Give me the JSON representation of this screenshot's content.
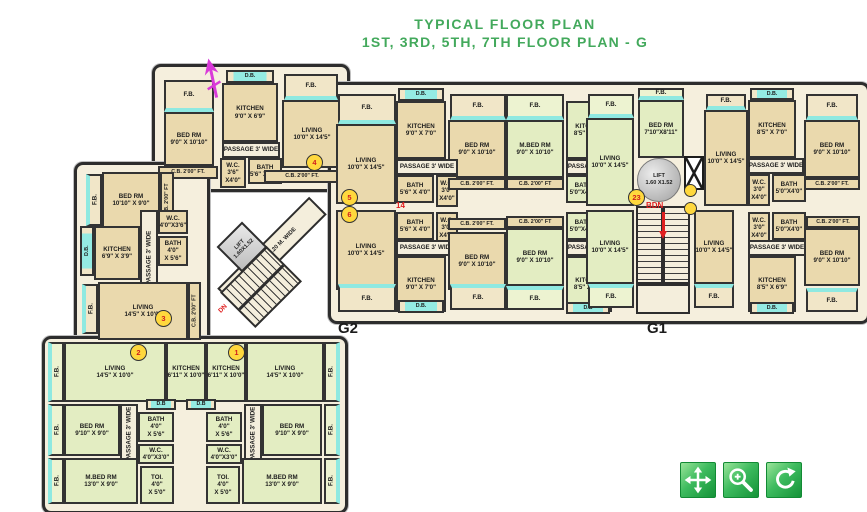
{
  "title": {
    "line1": "TYPICAL FLOOR PLAN",
    "line2": "1ST, 3RD, 5TH, 7TH FLOOR PLAN - G"
  },
  "wings": {
    "g1": "G1",
    "g2": "G2"
  },
  "core": {
    "lift_core_l1": "LIFT",
    "lift_core_l2": "1.60X1.52",
    "lift_g1_l1": "LIFT",
    "lift_g1_l2": "1.60 X1.52",
    "passage_diag": "PASSAGE 1.20 M. WIDE",
    "up": "UP",
    "dn": "DN",
    "bdn": "BDN"
  },
  "colors": {
    "title_green": "#43a95c",
    "wall": "#2d2d2d",
    "room_tan": "#ead9ad",
    "room_green": "#e3edc2",
    "window_cyan": "#8fe9e1",
    "badge_yellow": "#ffd83d",
    "annotation_red": "#e02020",
    "north_arrow_magenta": "#d93ad9",
    "button_green_light": "#9ae49a",
    "button_green_dark": "#149238"
  },
  "badges": [
    {
      "n": "4",
      "x": 306,
      "y": 154
    },
    {
      "n": "3",
      "x": 155,
      "y": 310
    },
    {
      "n": "5",
      "x": 341,
      "y": 189
    },
    {
      "n": "6",
      "x": 341,
      "y": 206
    },
    {
      "n": "2",
      "x": 130,
      "y": 344
    },
    {
      "n": "1",
      "x": 228,
      "y": 344
    },
    {
      "n": "23",
      "x": 628,
      "y": 189
    }
  ],
  "doors": [
    [
      684,
      184
    ],
    [
      684,
      202
    ]
  ],
  "annotations": [
    {
      "t": "14",
      "x": 396,
      "y": 201
    },
    {
      "t": "BDN",
      "x": 646,
      "y": 201
    }
  ],
  "toolbar": {
    "buttons": [
      {
        "name": "pan",
        "icon": "move-icon"
      },
      {
        "name": "zoom-in",
        "icon": "zoom-in-icon"
      },
      {
        "name": "rotate",
        "icon": "rotate-icon"
      }
    ]
  },
  "rooms": [
    {
      "x": 164,
      "y": 80,
      "w": 50,
      "h": 32,
      "c": "bal",
      "win": "b",
      "l": [
        "F.B."
      ]
    },
    {
      "x": 164,
      "y": 112,
      "w": 50,
      "h": 54,
      "c": "tan",
      "l": [
        "BED RM",
        "9'0\" X 10'10\""
      ]
    },
    {
      "x": 158,
      "y": 166,
      "w": 60,
      "h": 13,
      "c": "strip",
      "l": [
        "C.B. 2'00\" FT."
      ]
    },
    {
      "x": 226,
      "y": 70,
      "w": 48,
      "h": 13,
      "c": "db",
      "l": [
        "D.B."
      ]
    },
    {
      "x": 222,
      "y": 83,
      "w": 56,
      "h": 59,
      "c": "tan",
      "l": [
        "KITCHEN",
        "9'0\" X 6'9\""
      ]
    },
    {
      "x": 222,
      "y": 142,
      "w": 58,
      "h": 16,
      "c": "cor",
      "l": [
        "PASSAGE 3' WIDE"
      ]
    },
    {
      "x": 220,
      "y": 158,
      "w": 26,
      "h": 30,
      "c": "tan",
      "l": [
        "W.C.",
        "3'6\"",
        "X4'0\""
      ]
    },
    {
      "x": 248,
      "y": 158,
      "w": 34,
      "h": 26,
      "c": "tan",
      "l": [
        "BATH",
        "5'6\" X 4'0\""
      ]
    },
    {
      "x": 284,
      "y": 74,
      "w": 54,
      "h": 26,
      "c": "bal",
      "win": "b",
      "l": [
        "F.B."
      ]
    },
    {
      "x": 282,
      "y": 100,
      "w": 60,
      "h": 68,
      "c": "tan",
      "l": [
        "LIVING",
        "10'0\" X 14'5\""
      ]
    },
    {
      "x": 264,
      "y": 170,
      "w": 76,
      "h": 13,
      "c": "strip",
      "l": [
        "C.B. 2'00\" FT."
      ]
    },
    {
      "x": 86,
      "y": 174,
      "w": 16,
      "h": 52,
      "c": "bal",
      "v": 1,
      "win": "r",
      "l": [
        "F.B."
      ]
    },
    {
      "x": 102,
      "y": 172,
      "w": 58,
      "h": 56,
      "c": "tan",
      "l": [
        "BED RM",
        "10'10\" X 9'0\""
      ]
    },
    {
      "x": 160,
      "y": 172,
      "w": 14,
      "h": 56,
      "c": "strip",
      "v": 1,
      "l": [
        "C.B. 2'00\" FT"
      ]
    },
    {
      "x": 80,
      "y": 226,
      "w": 14,
      "h": 50,
      "c": "db",
      "v": 1,
      "l": [
        "D.B."
      ]
    },
    {
      "x": 94,
      "y": 226,
      "w": 46,
      "h": 54,
      "c": "tan",
      "l": [
        "KITCHEN",
        "6'9\" X 3'9\""
      ]
    },
    {
      "x": 140,
      "y": 210,
      "w": 18,
      "h": 96,
      "c": "cor",
      "v": 1,
      "l": [
        "PASSAGE 3' WIDE"
      ]
    },
    {
      "x": 158,
      "y": 210,
      "w": 30,
      "h": 24,
      "c": "tan",
      "l": [
        "W.C.",
        "4'0\"X3'6\""
      ]
    },
    {
      "x": 158,
      "y": 236,
      "w": 30,
      "h": 30,
      "c": "tan",
      "l": [
        "BATH",
        "4'0\"",
        "X 5'6\""
      ]
    },
    {
      "x": 82,
      "y": 284,
      "w": 16,
      "h": 50,
      "c": "bal",
      "v": 1,
      "win": "r",
      "l": [
        "F.B."
      ]
    },
    {
      "x": 98,
      "y": 282,
      "w": 90,
      "h": 58,
      "c": "tan",
      "l": [
        "LIVING",
        "14'5\" X 10'0\""
      ]
    },
    {
      "x": 188,
      "y": 282,
      "w": 13,
      "h": 58,
      "c": "strip",
      "v": 1,
      "l": [
        "C.B. 2'00\" FT"
      ]
    },
    {
      "x": 338,
      "y": 94,
      "w": 58,
      "h": 30,
      "c": "bal",
      "win": "b",
      "l": [
        "F.B."
      ]
    },
    {
      "x": 398,
      "y": 88,
      "w": 46,
      "h": 13,
      "c": "db",
      "l": [
        "D.B."
      ]
    },
    {
      "x": 396,
      "y": 101,
      "w": 50,
      "h": 58,
      "c": "tan",
      "l": [
        "KITCHEN",
        "9'0\" X 7'0\""
      ]
    },
    {
      "x": 450,
      "y": 94,
      "w": 56,
      "h": 26,
      "c": "bal",
      "win": "b",
      "l": [
        "F.B."
      ]
    },
    {
      "x": 336,
      "y": 124,
      "w": 60,
      "h": 80,
      "c": "tan",
      "l": [
        "LIVING",
        "10'0\" X 14'5\""
      ]
    },
    {
      "x": 448,
      "y": 120,
      "w": 58,
      "h": 58,
      "c": "tan",
      "l": [
        "BED RM",
        "9'0\" X 10'10\""
      ]
    },
    {
      "x": 396,
      "y": 159,
      "w": 62,
      "h": 16,
      "c": "cor",
      "l": [
        "PASSAGE 3' WIDE"
      ]
    },
    {
      "x": 396,
      "y": 175,
      "w": 38,
      "h": 28,
      "c": "tan",
      "l": [
        "BATH",
        "5'6\" X 4'0\""
      ]
    },
    {
      "x": 436,
      "y": 175,
      "w": 22,
      "h": 32,
      "c": "tan",
      "l": [
        "W.C.",
        "3'0\"",
        "X4'0\""
      ]
    },
    {
      "x": 448,
      "y": 178,
      "w": 58,
      "h": 12,
      "c": "strip",
      "l": [
        "C.B. 2'00\" FT."
      ]
    },
    {
      "x": 396,
      "y": 212,
      "w": 38,
      "h": 28,
      "c": "tan",
      "l": [
        "BATH",
        "5'6\" X 4'0\""
      ]
    },
    {
      "x": 436,
      "y": 212,
      "w": 22,
      "h": 32,
      "c": "tan",
      "l": [
        "W.C.",
        "3'0\"",
        "X4'0\""
      ]
    },
    {
      "x": 448,
      "y": 218,
      "w": 58,
      "h": 12,
      "c": "strip",
      "l": [
        "C.B. 2'00\" FT."
      ]
    },
    {
      "x": 336,
      "y": 210,
      "w": 60,
      "h": 80,
      "c": "tan",
      "l": [
        "LIVING",
        "10'0\" X 14'5\""
      ]
    },
    {
      "x": 396,
      "y": 240,
      "w": 62,
      "h": 16,
      "c": "cor",
      "l": [
        "PASSAGE 3' WIDE"
      ]
    },
    {
      "x": 448,
      "y": 232,
      "w": 58,
      "h": 58,
      "c": "tan",
      "l": [
        "BED RM",
        "9'0\" X 10'10\""
      ]
    },
    {
      "x": 396,
      "y": 256,
      "w": 50,
      "h": 56,
      "c": "tan",
      "l": [
        "KITCHEN",
        "9'0\" X 7'0\""
      ]
    },
    {
      "x": 338,
      "y": 284,
      "w": 58,
      "h": 28,
      "c": "bal",
      "win": "t",
      "l": [
        "F.B."
      ]
    },
    {
      "x": 450,
      "y": 284,
      "w": 56,
      "h": 26,
      "c": "bal",
      "win": "t",
      "l": [
        "F.B."
      ]
    },
    {
      "x": 398,
      "y": 300,
      "w": 46,
      "h": 13,
      "c": "db",
      "l": [
        "D.B."
      ]
    },
    {
      "x": 506,
      "y": 94,
      "w": 58,
      "h": 26,
      "c": "gbal",
      "win": "b",
      "l": [
        "F.B."
      ]
    },
    {
      "x": 506,
      "y": 120,
      "w": 58,
      "h": 58,
      "c": "green",
      "l": [
        "M.BED RM",
        "9'0\" X 10'10\""
      ]
    },
    {
      "x": 566,
      "y": 101,
      "w": 46,
      "h": 58,
      "c": "green",
      "l": [
        "KITCHEN",
        "8'5\" X 7'0\""
      ]
    },
    {
      "x": 566,
      "y": 159,
      "w": 58,
      "h": 16,
      "c": "cor",
      "l": [
        "PASSAGE 3' WIDE"
      ]
    },
    {
      "x": 566,
      "y": 175,
      "w": 34,
      "h": 28,
      "c": "green",
      "l": [
        "BATH",
        "5'0\"X4'0\""
      ]
    },
    {
      "x": 602,
      "y": 175,
      "w": 20,
      "h": 30,
      "c": "green",
      "l": [
        "W.C.",
        "3'0\"",
        "X4'0\""
      ]
    },
    {
      "x": 506,
      "y": 178,
      "w": 58,
      "h": 12,
      "c": "strip",
      "l": [
        "C.B. 2'00\" FT"
      ]
    },
    {
      "x": 588,
      "y": 94,
      "w": 46,
      "h": 24,
      "c": "gbal",
      "win": "b",
      "l": [
        "F.B."
      ]
    },
    {
      "x": 586,
      "y": 118,
      "w": 48,
      "h": 88,
      "c": "green",
      "l": [
        "LIVING",
        "10'0\" X 14'5\""
      ]
    },
    {
      "x": 638,
      "y": 88,
      "w": 46,
      "h": 12,
      "c": "gbal",
      "win": "b",
      "l": [
        "F.B."
      ]
    },
    {
      "x": 638,
      "y": 100,
      "w": 46,
      "h": 58,
      "c": "green",
      "l": [
        "BED RM",
        "7'10\"X8'11\""
      ]
    },
    {
      "x": 506,
      "y": 216,
      "w": 58,
      "h": 12,
      "c": "strip",
      "l": [
        "C.B. 2'00\" FT"
      ]
    },
    {
      "x": 506,
      "y": 228,
      "w": 58,
      "h": 58,
      "c": "green",
      "l": [
        "BED RM",
        "9'0\" X 10'10\""
      ]
    },
    {
      "x": 566,
      "y": 212,
      "w": 34,
      "h": 28,
      "c": "green",
      "l": [
        "BATH",
        "5'0\"X4'0\""
      ]
    },
    {
      "x": 602,
      "y": 212,
      "w": 20,
      "h": 30,
      "c": "green",
      "l": [
        "W.C.",
        "3'0\"",
        "X4'0\""
      ]
    },
    {
      "x": 566,
      "y": 240,
      "w": 58,
      "h": 16,
      "c": "cor",
      "l": [
        "PASSAGE 3' WIDE"
      ]
    },
    {
      "x": 566,
      "y": 256,
      "w": 46,
      "h": 56,
      "c": "green",
      "l": [
        "KITCHEN",
        "8'5\" X 7'0\""
      ]
    },
    {
      "x": 506,
      "y": 286,
      "w": 58,
      "h": 24,
      "c": "gbal",
      "win": "t",
      "l": [
        "F.B."
      ]
    },
    {
      "x": 566,
      "y": 302,
      "w": 44,
      "h": 12,
      "c": "db",
      "l": [
        "D.B"
      ]
    },
    {
      "x": 588,
      "y": 284,
      "w": 46,
      "h": 24,
      "c": "gbal",
      "win": "t",
      "l": [
        "F.B."
      ]
    },
    {
      "x": 586,
      "y": 210,
      "w": 48,
      "h": 74,
      "c": "green",
      "l": [
        "LIVING",
        "10'0\" X 14'5\""
      ]
    },
    {
      "x": 706,
      "y": 94,
      "w": 40,
      "h": 16,
      "c": "bal",
      "win": "b",
      "l": [
        "F.B."
      ]
    },
    {
      "x": 704,
      "y": 110,
      "w": 44,
      "h": 96,
      "c": "tan",
      "l": [
        "LIVING",
        "10'0\" X 14'5\""
      ]
    },
    {
      "x": 750,
      "y": 88,
      "w": 44,
      "h": 12,
      "c": "db",
      "l": [
        "D.B."
      ]
    },
    {
      "x": 748,
      "y": 100,
      "w": 48,
      "h": 58,
      "c": "tan",
      "l": [
        "KITCHEN",
        "8'5\" X 7'0\""
      ]
    },
    {
      "x": 748,
      "y": 158,
      "w": 56,
      "h": 16,
      "c": "cor",
      "l": [
        "PASSAGE 3' WIDE"
      ]
    },
    {
      "x": 748,
      "y": 174,
      "w": 22,
      "h": 32,
      "c": "tan",
      "l": [
        "W.C.",
        "3'0\"",
        "X4'0\""
      ]
    },
    {
      "x": 772,
      "y": 174,
      "w": 34,
      "h": 28,
      "c": "tan",
      "l": [
        "BATH",
        "5'0\"X4'0\""
      ]
    },
    {
      "x": 806,
      "y": 94,
      "w": 52,
      "h": 26,
      "c": "bal",
      "win": "b",
      "l": [
        "F.B."
      ]
    },
    {
      "x": 804,
      "y": 120,
      "w": 56,
      "h": 58,
      "c": "tan",
      "l": [
        "BED RM",
        "9'0\" X 10'10\""
      ]
    },
    {
      "x": 804,
      "y": 178,
      "w": 56,
      "h": 12,
      "c": "strip",
      "l": [
        "C.B. 2'00\" FT."
      ]
    },
    {
      "x": 748,
      "y": 212,
      "w": 22,
      "h": 32,
      "c": "tan",
      "l": [
        "W.C.",
        "3'0\"",
        "X4'0\""
      ]
    },
    {
      "x": 772,
      "y": 212,
      "w": 34,
      "h": 28,
      "c": "tan",
      "l": [
        "BATH",
        "5'0\"X4'0\""
      ]
    },
    {
      "x": 806,
      "y": 216,
      "w": 54,
      "h": 12,
      "c": "strip",
      "l": [
        "C.B. 2'00\" FT."
      ]
    },
    {
      "x": 694,
      "y": 210,
      "w": 40,
      "h": 74,
      "c": "tan",
      "l": [
        "LIVING",
        "10'0\" X 14'5\""
      ]
    },
    {
      "x": 748,
      "y": 240,
      "w": 58,
      "h": 16,
      "c": "cor",
      "l": [
        "PASSAGE 3' WIDE"
      ]
    },
    {
      "x": 748,
      "y": 256,
      "w": 48,
      "h": 56,
      "c": "tan",
      "l": [
        "KITCHEN",
        "8'5\" X 6'9\""
      ]
    },
    {
      "x": 750,
      "y": 302,
      "w": 44,
      "h": 12,
      "c": "db",
      "l": [
        "D.B."
      ]
    },
    {
      "x": 804,
      "y": 228,
      "w": 56,
      "h": 58,
      "c": "tan",
      "l": [
        "BED RM",
        "9'0\" X 10'10\""
      ]
    },
    {
      "x": 806,
      "y": 288,
      "w": 52,
      "h": 24,
      "c": "bal",
      "win": "t",
      "l": [
        "F.B."
      ]
    },
    {
      "x": 694,
      "y": 284,
      "w": 40,
      "h": 24,
      "c": "bal",
      "win": "t",
      "l": [
        "F.B."
      ]
    },
    {
      "x": 48,
      "y": 342,
      "w": 16,
      "h": 60,
      "c": "gbal",
      "v": 1,
      "win": "r",
      "l": [
        "F.B."
      ]
    },
    {
      "x": 64,
      "y": 342,
      "w": 102,
      "h": 60,
      "c": "green",
      "l": [
        "LIVING",
        "14'5\" X 10'0\""
      ]
    },
    {
      "x": 166,
      "y": 342,
      "w": 40,
      "h": 60,
      "c": "green",
      "l": [
        "KITCHEN",
        "6'11\" X 10'0\""
      ]
    },
    {
      "x": 206,
      "y": 342,
      "w": 40,
      "h": 60,
      "c": "green",
      "l": [
        "KITCHEN",
        "6'11\" X 10'0\""
      ]
    },
    {
      "x": 246,
      "y": 342,
      "w": 78,
      "h": 60,
      "c": "green",
      "l": [
        "LIVING",
        "14'5\" X 10'0\""
      ]
    },
    {
      "x": 324,
      "y": 342,
      "w": 16,
      "h": 60,
      "c": "gbal",
      "v": 1,
      "win": "l",
      "l": [
        "F.B."
      ]
    },
    {
      "x": 48,
      "y": 404,
      "w": 16,
      "h": 52,
      "c": "gbal",
      "v": 1,
      "win": "r",
      "l": [
        "F.B."
      ]
    },
    {
      "x": 64,
      "y": 404,
      "w": 56,
      "h": 52,
      "c": "green",
      "l": [
        "BED RM",
        "9'10\" X 9'0\""
      ]
    },
    {
      "x": 120,
      "y": 404,
      "w": 18,
      "h": 60,
      "c": "cor",
      "v": 1,
      "l": [
        "PASSAGE 3' WIDE"
      ]
    },
    {
      "x": 146,
      "y": 399,
      "w": 30,
      "h": 11,
      "c": "db",
      "l": [
        "D.B"
      ]
    },
    {
      "x": 138,
      "y": 412,
      "w": 36,
      "h": 30,
      "c": "green",
      "l": [
        "BATH",
        "4'0\"",
        "X 5'6\""
      ]
    },
    {
      "x": 138,
      "y": 444,
      "w": 36,
      "h": 20,
      "c": "green",
      "l": [
        "W.C.",
        "4'0\"X3'0\""
      ]
    },
    {
      "x": 186,
      "y": 399,
      "w": 30,
      "h": 11,
      "c": "db",
      "l": [
        "D.B"
      ]
    },
    {
      "x": 206,
      "y": 412,
      "w": 36,
      "h": 30,
      "c": "green",
      "l": [
        "BATH",
        "4'0\"",
        "X 5'6\""
      ]
    },
    {
      "x": 206,
      "y": 444,
      "w": 36,
      "h": 20,
      "c": "green",
      "l": [
        "W.C.",
        "4'0\"X3'0\""
      ]
    },
    {
      "x": 244,
      "y": 404,
      "w": 18,
      "h": 60,
      "c": "cor",
      "v": 1,
      "l": [
        "PASSAGE 3' WIDE"
      ]
    },
    {
      "x": 262,
      "y": 404,
      "w": 60,
      "h": 52,
      "c": "green",
      "l": [
        "BED RM",
        "9'10\" X 9'0\""
      ]
    },
    {
      "x": 324,
      "y": 404,
      "w": 16,
      "h": 52,
      "c": "gbal",
      "v": 1,
      "win": "l",
      "l": [
        "F.B."
      ]
    },
    {
      "x": 48,
      "y": 458,
      "w": 16,
      "h": 46,
      "c": "gbal",
      "v": 1,
      "win": "r",
      "l": [
        "F.B."
      ]
    },
    {
      "x": 64,
      "y": 458,
      "w": 74,
      "h": 46,
      "c": "green",
      "l": [
        "M.BED RM",
        "13'0\" X 9'0\""
      ]
    },
    {
      "x": 140,
      "y": 466,
      "w": 34,
      "h": 38,
      "c": "green",
      "l": [
        "TOI.",
        "4'0\"",
        "X 5'0\""
      ]
    },
    {
      "x": 206,
      "y": 466,
      "w": 34,
      "h": 38,
      "c": "green",
      "l": [
        "TOI.",
        "4'0\"",
        "X 5'0\""
      ]
    },
    {
      "x": 242,
      "y": 458,
      "w": 80,
      "h": 46,
      "c": "green",
      "l": [
        "M.BED RM",
        "13'0\" X 9'0\""
      ]
    },
    {
      "x": 324,
      "y": 458,
      "w": 16,
      "h": 46,
      "c": "gbal",
      "v": 1,
      "win": "l",
      "l": [
        "F.B."
      ]
    }
  ]
}
